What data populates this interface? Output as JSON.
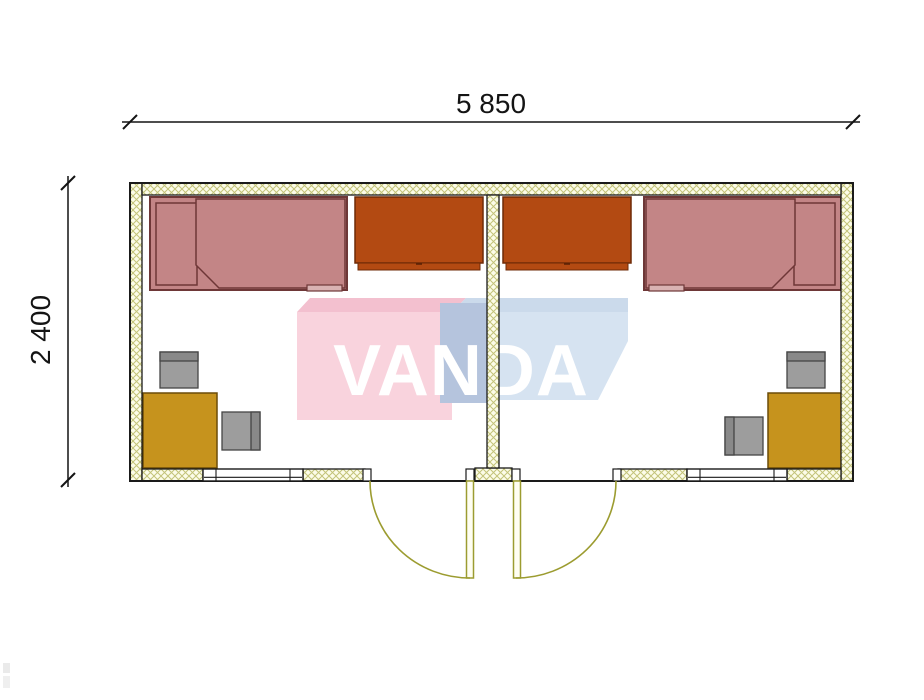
{
  "drawing": {
    "kind": "container-house floor plan, top view",
    "rooms": [
      {
        "name": "left room",
        "furniture": [
          "single-bed",
          "wardrobe",
          "desk",
          "chair",
          "chair"
        ],
        "openings": [
          "window",
          "outward-swing door"
        ]
      },
      {
        "name": "right room",
        "furniture": [
          "single-bed",
          "wardrobe",
          "desk",
          "chair",
          "chair"
        ],
        "openings": [
          "window",
          "outward-swing door"
        ]
      }
    ]
  },
  "dimensions": {
    "width_label": "5 850",
    "height_label": "2 400"
  },
  "watermark": {
    "brand": "VANDA"
  },
  "colors": {
    "wall_fill": "#fcfce8",
    "wall_hatch": "#c3c379",
    "wall_stroke": "#1a1a1a",
    "bed_fill": "#c38586",
    "bed_stroke": "#6e3737",
    "bed_foot_fill": "#d9b2b2",
    "wardrobe_fill": "#b34a12",
    "wardrobe_stroke": "#6e2a06",
    "desk_fill": "#c6931d",
    "desk_stroke": "#6b4c08",
    "chair_fill": "#9d9d9d",
    "chair_back_fill": "#898989",
    "chair_stroke": "#454545",
    "door_stroke": "#9c9c30",
    "door_leaf_fill": "#fffef2",
    "window_fill": "#ffffff",
    "dim_color": "#141414",
    "wm_pink": "#f8ccd8",
    "wm_pink_top": "#f2b6c7",
    "wm_blue": "#cfdfef",
    "wm_blue_top": "#c3d4e8",
    "wm_blue_side": "#a9bad8",
    "wm_text_color": "#ffffff"
  }
}
